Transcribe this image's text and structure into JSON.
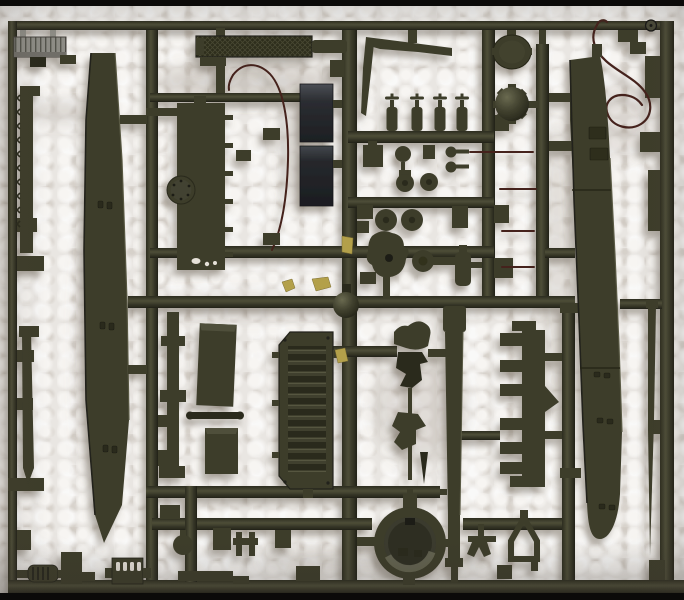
{
  "scene": {
    "description": "Photograph of a dark olive-green injection-molded model kit sprue (parts tree) lying on white styrofoam packing foam",
    "photo_alt": "Olive drab plastic model sprue with tank parts on white styrofoam",
    "background": "white styrofoam with bubble cell texture",
    "lighting": "soft daylight from upper right; parts cast soft shadows down-left",
    "film_border": "thin black strips at top and bottom photo edges"
  },
  "palette": {
    "olive": "#3c3c2a",
    "olive_dark": "#2b2b1d",
    "olive_deep": "#1f1f15",
    "olive_light": "#515139",
    "olive_hi": "#6e6e52",
    "gray_part": "#8d8c85",
    "gray_part_dark": "#53524c",
    "panel_dark": "#25272b",
    "panel_sheen": "#4b4f55",
    "wire_brown": "#44231b",
    "tape_yellow": "#b3a04a",
    "foam_base": "#e9e6e2",
    "foam_hi": "#f7f5f2",
    "foam_shadow": "#cfc9c3",
    "film_black": "#0b0a09"
  },
  "parts": {
    "frame_label": "rectangular sprue frame with runner rails",
    "items": [
      {
        "id": "gray-ribbed-plate",
        "label": "light gray ribbed hatch plate (top left)"
      },
      {
        "id": "toothed-strip",
        "label": "thin toothed strip on left rail"
      },
      {
        "id": "left-skirt-blade",
        "label": "long tapered hull side skirt with hinge detail"
      },
      {
        "id": "thin-pointed-rod",
        "label": "thin pointed rod on left rail"
      },
      {
        "id": "engine-deck-plate",
        "label": "cross-hatched engine deck grille bar"
      },
      {
        "id": "turret-roof-plate",
        "label": "flat roof plate with round bolted hatch"
      },
      {
        "id": "antenna-wire",
        "label": "thin brown antenna wire arc"
      },
      {
        "id": "dark-panels",
        "label": "two glossy near-black panels"
      },
      {
        "id": "scythe-blades",
        "label": "two thin tapered blades joined at left"
      },
      {
        "id": "bottle-row",
        "label": "four bottle-shaped fittings on runner"
      },
      {
        "id": "small-fittings",
        "label": "knobs, pins and drum fittings cluster"
      },
      {
        "id": "hatch-disc",
        "label": "flat circular hatch disc"
      },
      {
        "id": "domed-cupola",
        "label": "domed cupola with radial lugs"
      },
      {
        "id": "thin-red-rods",
        "label": "four thin dark-brown rods"
      },
      {
        "id": "tow-cable-wire",
        "label": "looped tow cable wire (top right)"
      },
      {
        "id": "stamp-mark",
        "label": "circular stamp on top rail"
      },
      {
        "id": "hull-side-right",
        "label": "long hull side panel with rounded nose"
      },
      {
        "id": "comb-plate",
        "label": "notched comb mounting plate"
      },
      {
        "id": "right-sliver-rod",
        "label": "tapered sliver rod at right edge"
      },
      {
        "id": "stowage-slabs",
        "label": "two rectangular stowage slabs"
      },
      {
        "id": "louvered-grille",
        "label": "louvered radiator grille panel"
      },
      {
        "id": "push-rod",
        "label": "short rod with rounded ends"
      },
      {
        "id": "vertical-rod",
        "label": "collared vertical rod"
      },
      {
        "id": "sprue-ball",
        "label": "small molded sphere at rail junction"
      },
      {
        "id": "clamp-cluster",
        "label": "irregular clamp and bracket parts"
      },
      {
        "id": "gun-barrel",
        "label": "long tapered gun barrel with muzzle step"
      },
      {
        "id": "turret-ring",
        "label": "large turret ring with inner detail"
      },
      {
        "id": "pentagon-outline",
        "label": "hollow pentagon bracket"
      },
      {
        "id": "v-bracket",
        "label": "small wishbone bracket"
      },
      {
        "id": "muffler",
        "label": "small ribbed muffler"
      },
      {
        "id": "slotted-bracket",
        "label": "bracket with four bright slots"
      },
      {
        "id": "tape-marks",
        "label": "yellow tape flecks on runners"
      }
    ]
  }
}
